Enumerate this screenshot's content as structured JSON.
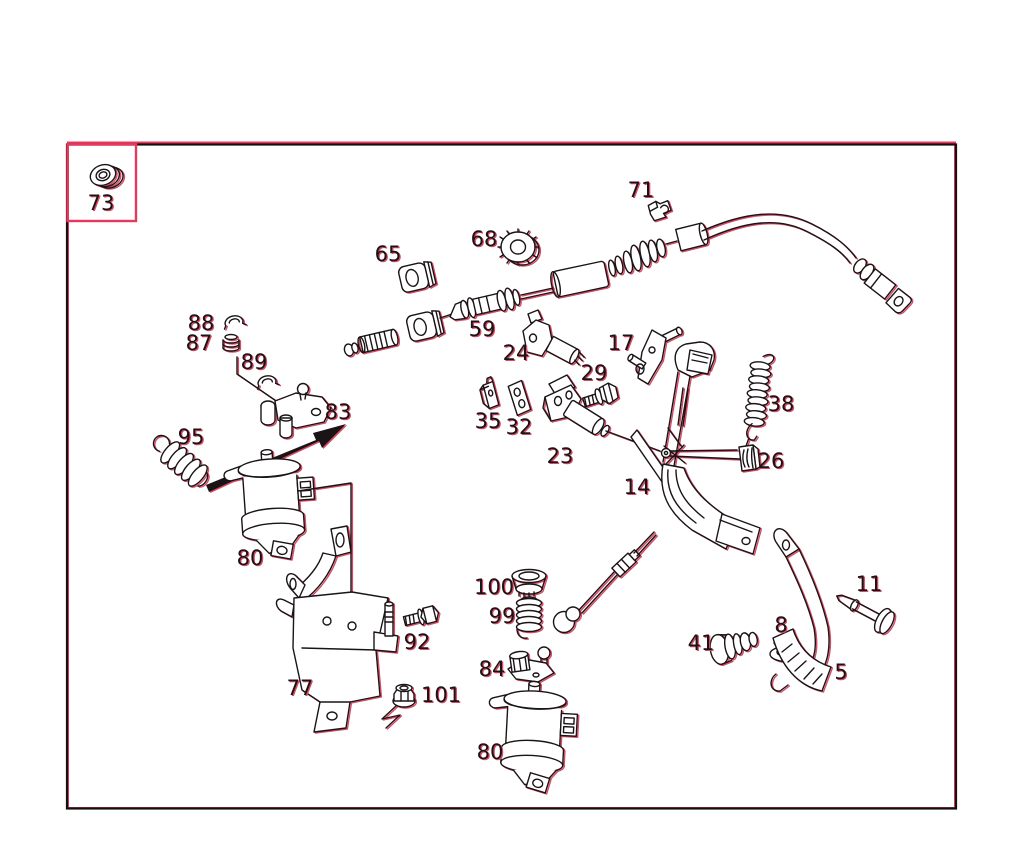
{
  "colors": {
    "ink": "#1a1416",
    "fringe": "#d94a63",
    "frame_red": "#e8385e",
    "frame_black": "#14100e",
    "paper": "#ffffff"
  },
  "parts": [
    {
      "number": "73",
      "x": 101,
      "y": 210
    },
    {
      "number": "88",
      "x": 201,
      "y": 330
    },
    {
      "number": "87",
      "x": 199,
      "y": 350
    },
    {
      "number": "89",
      "x": 254,
      "y": 369
    },
    {
      "number": "83",
      "x": 338,
      "y": 419
    },
    {
      "number": "95",
      "x": 191,
      "y": 444
    },
    {
      "number": "80",
      "x": 250,
      "y": 565
    },
    {
      "number": "77",
      "x": 300,
      "y": 695
    },
    {
      "number": "92",
      "x": 417,
      "y": 649
    },
    {
      "number": "101",
      "x": 441,
      "y": 702
    },
    {
      "number": "65",
      "x": 388,
      "y": 261
    },
    {
      "number": "68",
      "x": 484,
      "y": 246
    },
    {
      "number": "59",
      "x": 482,
      "y": 336
    },
    {
      "number": "24",
      "x": 516,
      "y": 360
    },
    {
      "number": "71",
      "x": 641,
      "y": 197
    },
    {
      "number": "17",
      "x": 621,
      "y": 350
    },
    {
      "number": "29",
      "x": 594,
      "y": 380
    },
    {
      "number": "35",
      "x": 488,
      "y": 428
    },
    {
      "number": "32",
      "x": 519,
      "y": 434
    },
    {
      "number": "23",
      "x": 560,
      "y": 463
    },
    {
      "number": "14",
      "x": 637,
      "y": 494
    },
    {
      "number": "38",
      "x": 781,
      "y": 411
    },
    {
      "number": "26",
      "x": 771,
      "y": 468
    },
    {
      "number": "100",
      "x": 494,
      "y": 594
    },
    {
      "number": "99",
      "x": 502,
      "y": 623
    },
    {
      "number": "84",
      "x": 492,
      "y": 676
    },
    {
      "number": "80",
      "x": 490,
      "y": 759
    },
    {
      "number": "11",
      "x": 869,
      "y": 591
    },
    {
      "number": "41",
      "x": 701,
      "y": 650
    },
    {
      "number": "8",
      "x": 781,
      "y": 632
    },
    {
      "number": "5",
      "x": 841,
      "y": 679
    }
  ]
}
